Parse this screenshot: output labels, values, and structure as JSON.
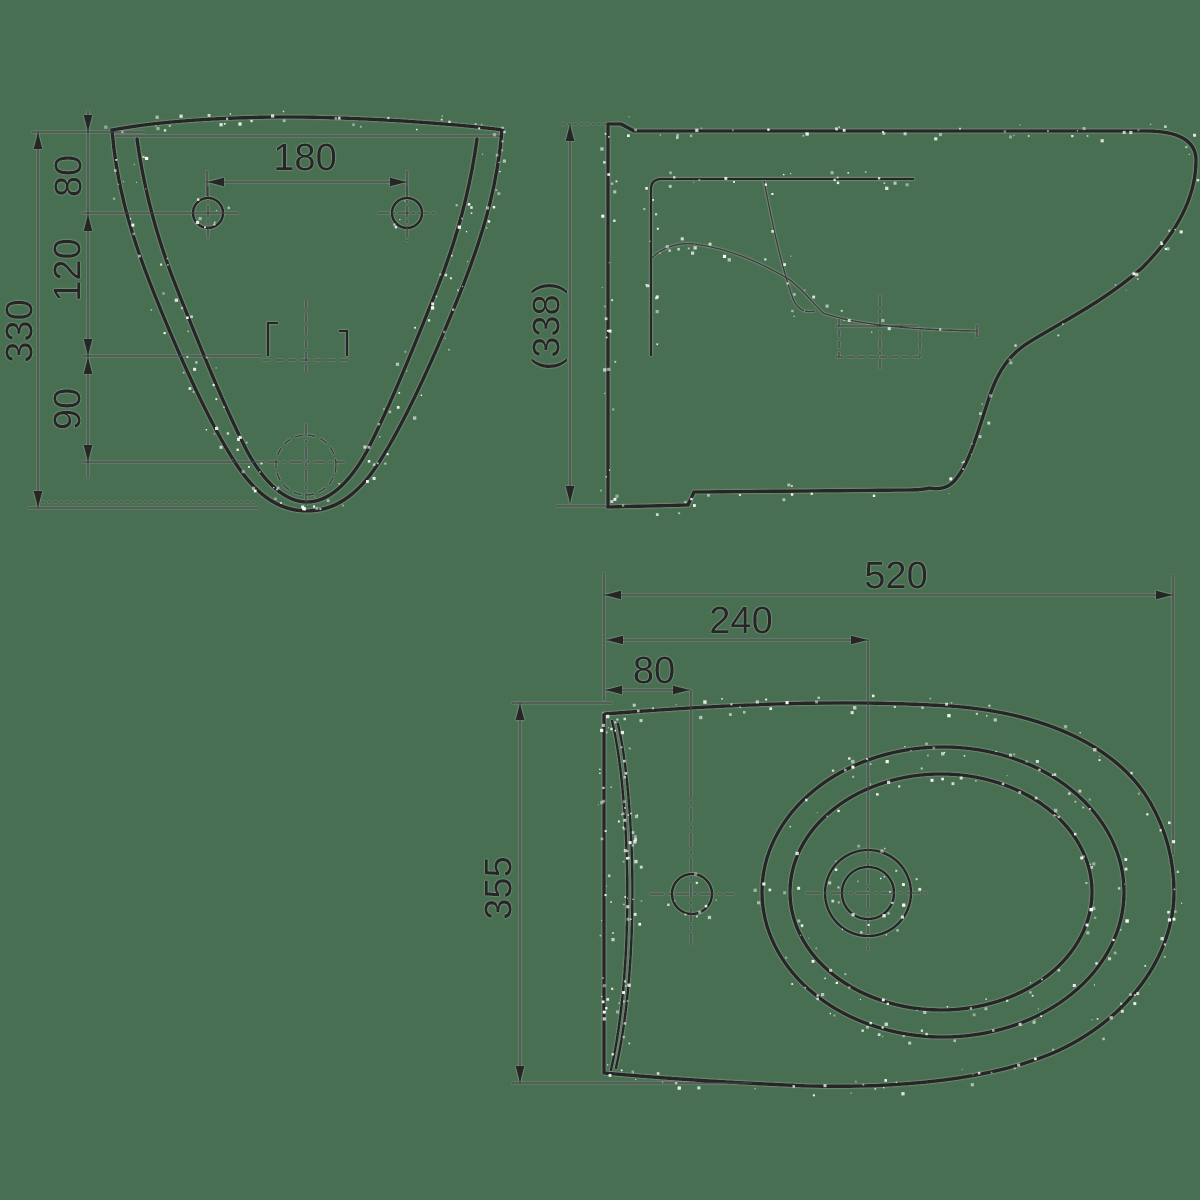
{
  "drawing": {
    "background_color": "#496F52",
    "line_color": "#272727",
    "thin_line_color": "#3d3d3d",
    "text_color": "#262626",
    "speckle_color": "#ffffff",
    "views": {
      "front": {
        "name": "front view",
        "dims": {
          "hole_spacing": "180",
          "rim_to_holes": "80",
          "holes_to_jet": "120",
          "jet_to_drain": "90",
          "overall_height": "330"
        }
      },
      "side": {
        "name": "side view",
        "dims": {
          "overall_height": "(338)"
        }
      },
      "plan": {
        "name": "plan view",
        "dims": {
          "overall_length": "520",
          "wall_to_drain": "240",
          "wall_to_tap_hole": "80",
          "overall_width": "355"
        }
      }
    }
  }
}
